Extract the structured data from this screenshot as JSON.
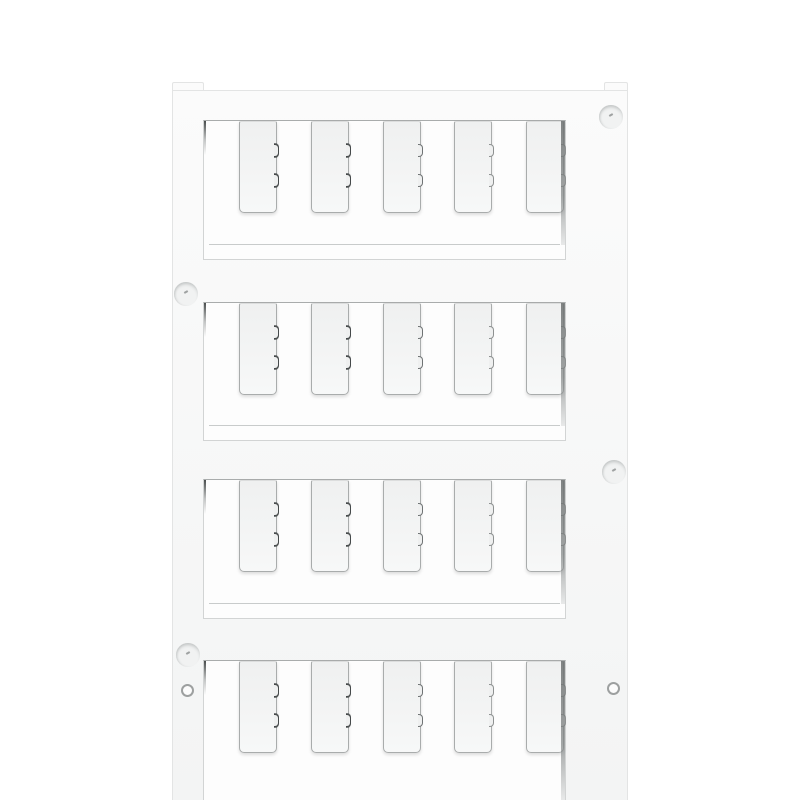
{
  "image": {
    "type": "product-photo",
    "subject": "Blank white plastic marker card (terminal marker sheet) with four windows of detachable blank marker tags",
    "background_color": "#ffffff"
  },
  "card": {
    "rows": 4,
    "tags_per_row": 5,
    "total_tags": 20,
    "tag_text": "",
    "mold_pins": 4,
    "mounting_holes": 2
  },
  "colors": {
    "bg": "#ffffff",
    "plastic_light": "#fbfbfb",
    "plastic_dark": "#f3f4f4",
    "outline": "#e3e4e4",
    "window_bg": "#fdfdfd",
    "window_border": "#d2d4d4",
    "window_border_top": "#a9acac",
    "ledge_line": "#c8cbcb",
    "tag_fill_top": "#eff0f0",
    "tag_fill_bottom": "#f7f8f8",
    "tag_border": "#a9acac",
    "notch_dark": "#45494a",
    "notch_light": "#8e9191",
    "pin_fill": "#f1f2f2",
    "pin_crescent": "#c2c5c5",
    "hole_ring": "#9da0a0"
  }
}
